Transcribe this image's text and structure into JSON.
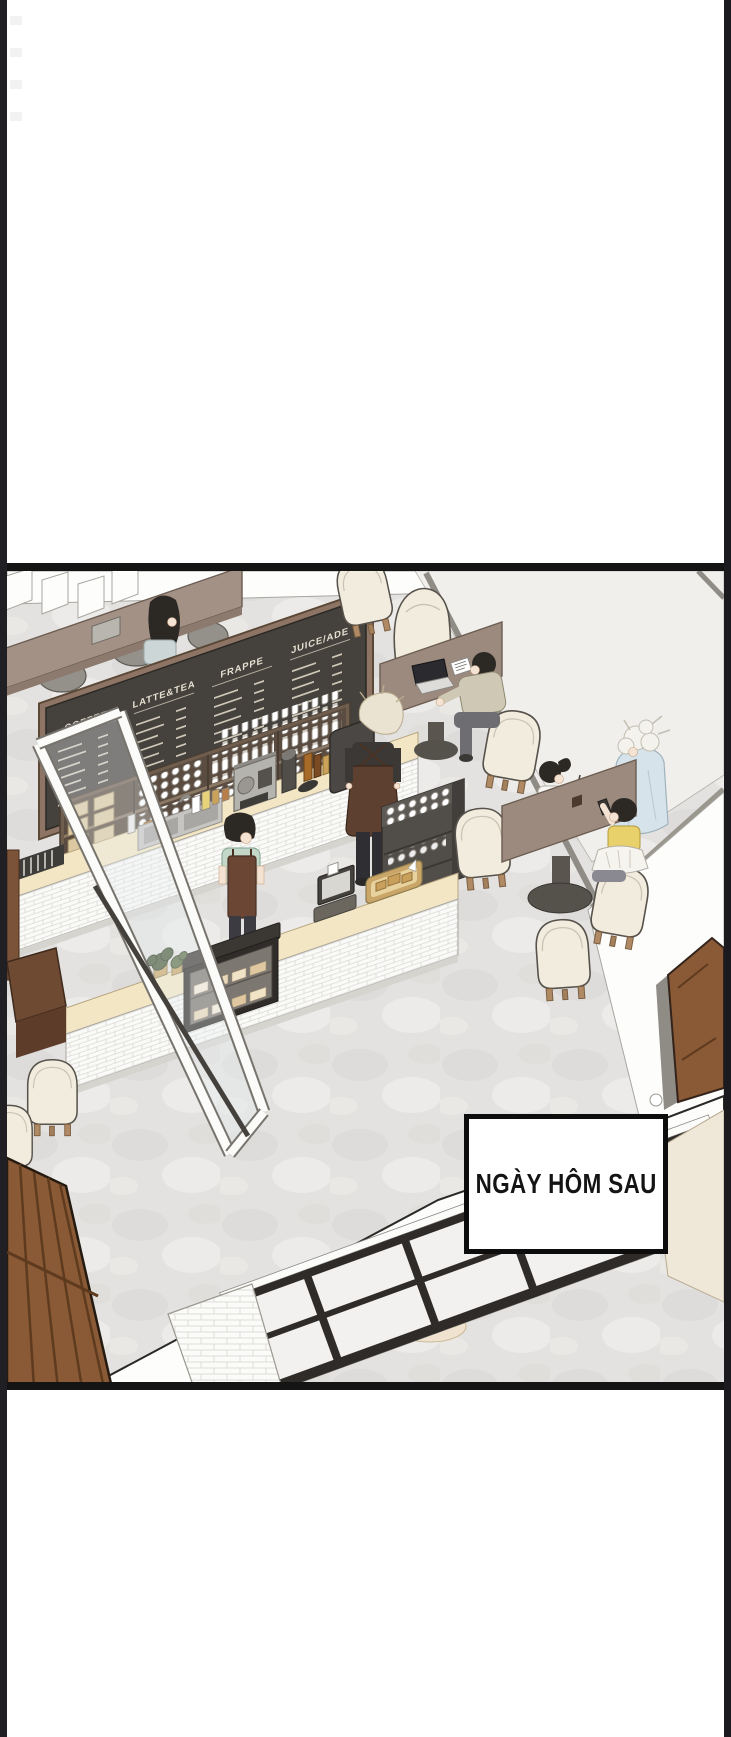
{
  "page": {
    "width": 731,
    "height": 1737,
    "margin_color": "#ffffff",
    "side_strip_color": "#202024",
    "panel_border_color": "#141414"
  },
  "panel": {
    "caption": {
      "text": "NGÀY HÔM SAU",
      "background": "#ffffff",
      "border_color": "#0d0d0d",
      "text_color": "#141414"
    },
    "menu_board": {
      "background": "#45413c",
      "frame_color": "#8d7464",
      "text_color": "#e6e0d2",
      "sections": [
        {
          "title": "COFFEE",
          "item_lines": 7
        },
        {
          "title": "LATTE&TEA",
          "item_lines": 8
        },
        {
          "title": "FRAPPE",
          "item_lines": 8
        },
        {
          "title": "JUICE/ADE",
          "item_lines": 9
        }
      ]
    },
    "scene": {
      "floor_color": "#e3e2e0",
      "counter_top_color": "#f3e6c4",
      "counter_tile_color": "#fafaf8",
      "table_wood_color": "#9b8a7d",
      "door_wood_color": "#8a5a36",
      "armchair_color": "#f2ecdf",
      "apron_color": "#6b4635",
      "barista_shirt_color": "#c3d8c8",
      "window_frame_color": "#2e2b29",
      "glass_color": "#f0efec",
      "accent_wall_color": "#efe7d8",
      "people_count": 7
    }
  }
}
